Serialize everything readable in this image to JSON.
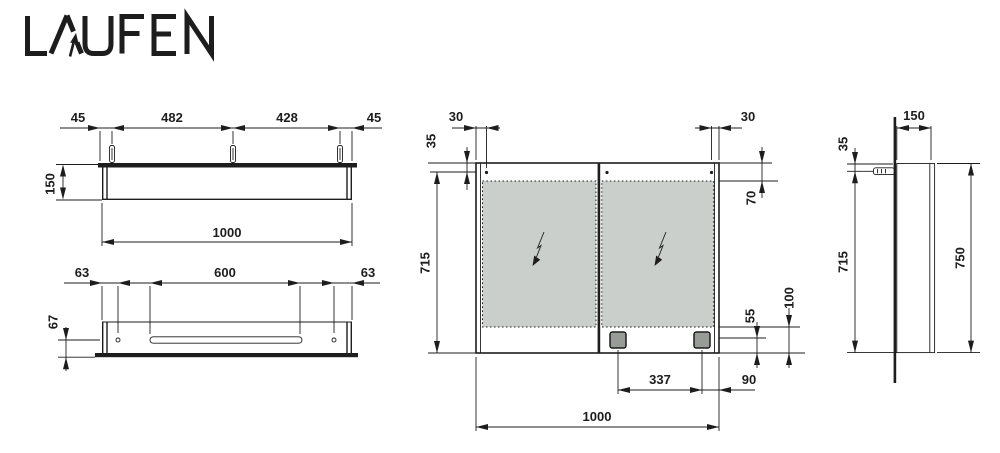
{
  "brand": {
    "logo_text": "LAUFEN"
  },
  "colors": {
    "line": "#1d1d1d",
    "mirror_glass": "#cbcfcb",
    "socket_fill": "#979c97",
    "background": "#ffffff"
  },
  "views": {
    "top_view": {
      "label": "top view",
      "dims": {
        "edge_to_clip_left": "45",
        "clip_spacing_1": "482",
        "clip_spacing_2": "428",
        "edge_to_clip_right": "45",
        "depth": "150",
        "overall_width": "1000"
      }
    },
    "bottom_view": {
      "label": "bottom view",
      "dims": {
        "edge_to_hole_left": "63",
        "slot_length": "600",
        "edge_to_hole_right": "63",
        "slot_inset": "67"
      }
    },
    "front_view": {
      "label": "front view",
      "dims": {
        "hinge_inset_left": "30",
        "top_to_hinge": "35",
        "hinge_inset_right": "30",
        "top_to_glass": "70",
        "body_height": "715",
        "socket_to_bottom": "55",
        "glass_to_bottom": "100",
        "socket_spacing": "337",
        "socket_to_edge": "90",
        "overall_width": "1000"
      }
    },
    "side_view": {
      "label": "side view",
      "dims": {
        "depth": "150",
        "top_to_anchor": "35",
        "body_height": "715",
        "overall_height": "750"
      }
    }
  }
}
